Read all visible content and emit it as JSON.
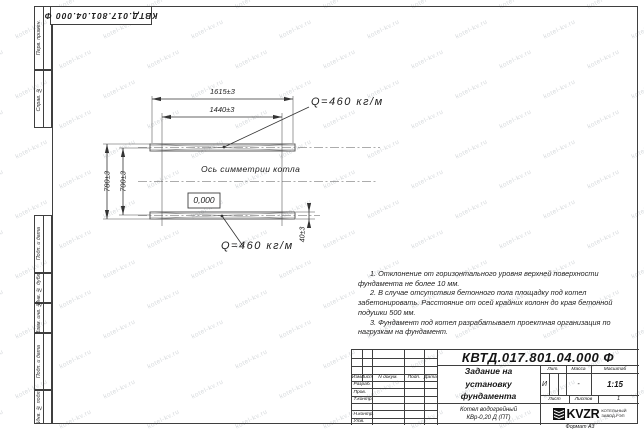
{
  "sheet": {
    "doc_number_top": "КВТД.017.801.04.000 Ф",
    "format_label": "Формат А3",
    "watermark": "kotel-kv.ru",
    "line_color": "#3f3f3f",
    "watermark_color": "#d8dbde"
  },
  "margin_labels": [
    "Перв. примен.",
    "Справ. №",
    "Подп. и дата",
    "Инв. № дубл.",
    "Взам. инв. №",
    "Подп. и дата",
    "Инв. № подл."
  ],
  "drawing": {
    "dim_length_outer": "1615±3",
    "dim_length_inner": "1440±3",
    "dim_height_outer": "780±3",
    "dim_height_inner": "700±3",
    "dim_rail_height": "40±3",
    "load_label_top": "Q=460 кг/м",
    "load_label_bottom": "Q=460 кг/м",
    "axis_label": "Ось симметрии котла",
    "level_mark": "0,000"
  },
  "notes": [
    "1. Отклонение от горизонтального уровня верхней поверхности фундамента не более 10 мм.",
    "2. В случае отсутствия бетонного пола площадку под котел забетонировать. Расстояние от осей крайних колонн до края бетонной подушки 500 мм.",
    "3. Фундамент под котел разрабатывает проектная организация по нагрузкам на фундамент."
  ],
  "title_block": {
    "designation": "КВТД.017.801.04.000 Ф",
    "title_line1": "Задание на",
    "title_line2": "установку",
    "title_line3": "фундамента",
    "product_line1": "Котел водогрейный",
    "product_line2": "КВр-0,20 Д (ПТ)",
    "header": {
      "izm": "Изм.",
      "list": "Лист",
      "ndoc": "N докум.",
      "podp": "Подп.",
      "data": "Дата"
    },
    "rows": [
      "Разраб.",
      "Пров.",
      "Т.контр.",
      "",
      "Н.контр.",
      "Утв."
    ],
    "lit_label": "Лит.",
    "massa_label": "Масса",
    "masshtab_label": "Масштаб",
    "lit_value": "И",
    "massa_value": "-",
    "masshtab_value": "1:15",
    "list_label": "Лист",
    "listov_label": "Листов",
    "listov_value": "1",
    "logo_text": "KVZR",
    "logo_sub1": "КОТЕЛЬНЫЙ",
    "logo_sub2": "ЗАВОД-РЭП"
  }
}
